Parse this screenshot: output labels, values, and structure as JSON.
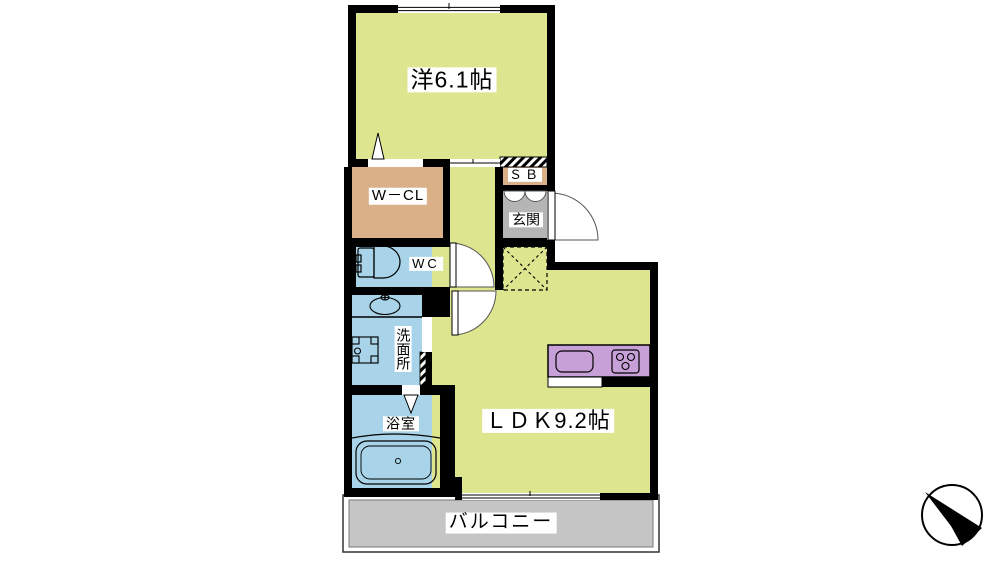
{
  "plan_title": "1LDK floor plan",
  "rooms": {
    "western_room": {
      "label": "洋6.1帖"
    },
    "walk_in_closet": {
      "label": "W－CL"
    },
    "shoe_box": {
      "label": "ＳＢ"
    },
    "entrance": {
      "label": "玄関"
    },
    "toilet": {
      "label": "WC"
    },
    "washroom": {
      "label": "洗面所"
    },
    "bathroom": {
      "label": "浴室"
    },
    "ldk": {
      "label": "ＬＤＫ9.2帖"
    },
    "balcony": {
      "label": "バルコニー"
    }
  },
  "icons": {
    "compass": "north-arrow-icon",
    "fixtures": [
      "toilet-icon",
      "washbasin-icon",
      "washing-machine-icon",
      "bathtub-icon",
      "kitchen-sink-icon",
      "stove-icon"
    ]
  },
  "colors": {
    "room_yellow": "#dde58f",
    "closet_tan": "#d9b088",
    "wet_area_blue": "#a8d3e8",
    "kitchen_purple": "#c8a0d8",
    "entrance_gray": "#b5b5b5",
    "balcony_gray": "#c5c5c5",
    "wall_black": "#000000"
  }
}
